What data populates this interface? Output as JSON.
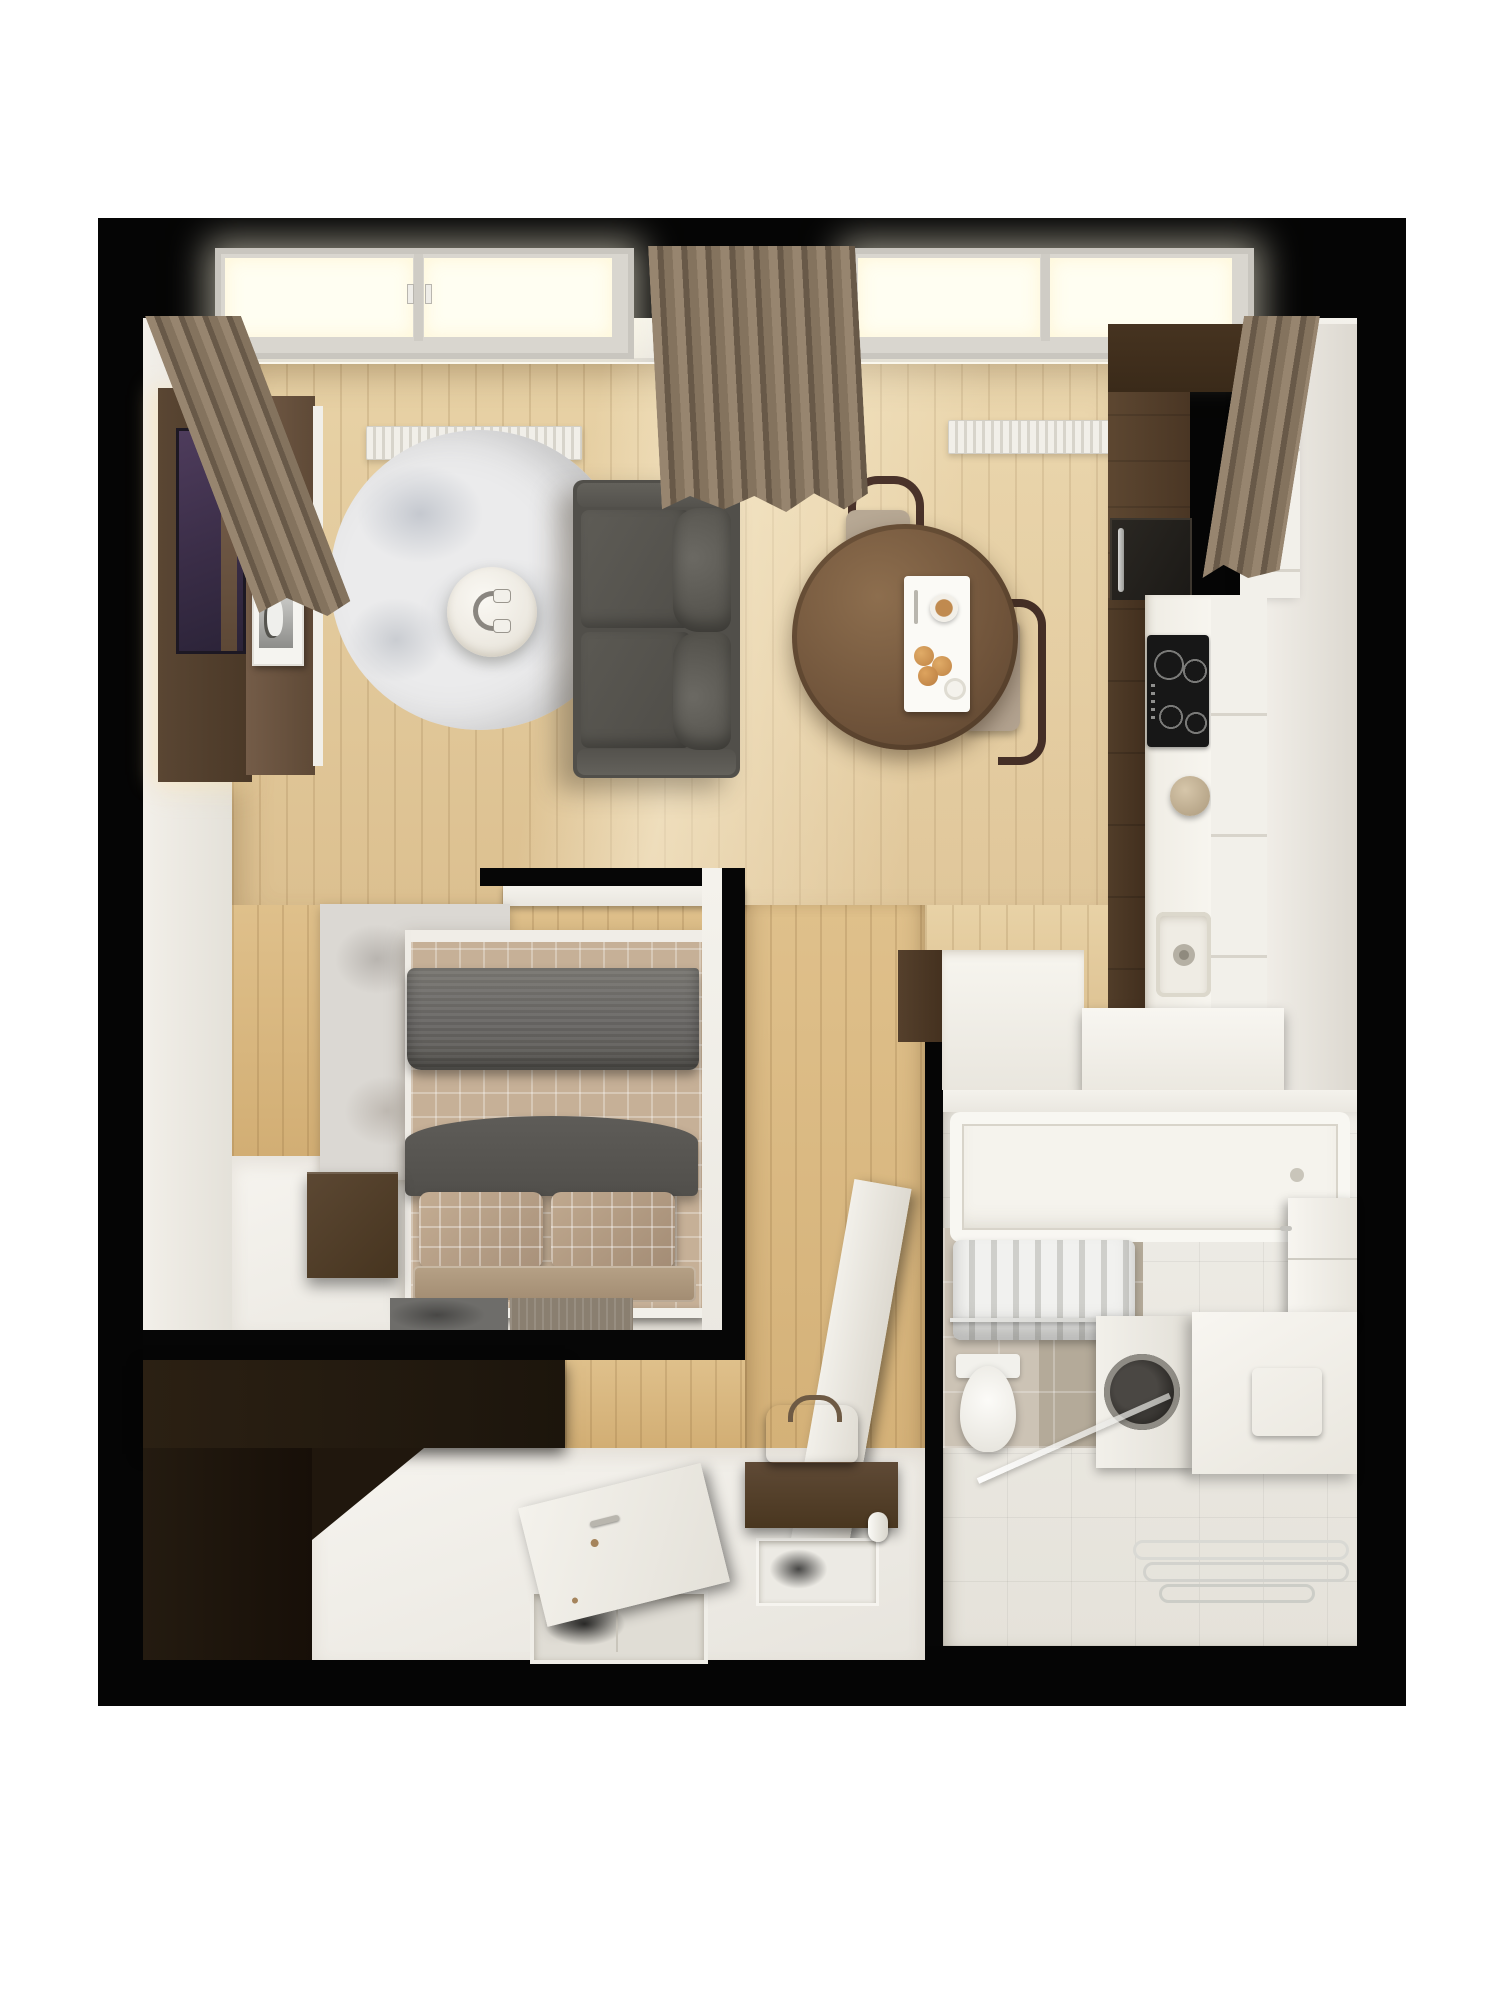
{
  "scene": {
    "type": "3d-floor-plan-render",
    "view": "top-down",
    "description": "Top-down 3D render of a small one-bedroom apartment on a black background"
  },
  "palette": {
    "page_bg": "#ffffff",
    "frame": "#050505",
    "wall": "#efece5",
    "wood_light": "#e3cb9d",
    "wood_dark": "#d5b47e",
    "curtain_brown": "#85735f",
    "sofa_gray": "#55534e",
    "kitchen_wood": "#54402d",
    "counter_white": "#f4f1ea",
    "rug_gray": "#e7e7e8",
    "bed_sheet": "#c6b097",
    "blanket_gray": "#6e6c67",
    "tile_beige": "#c6bcae",
    "wardrobe_dark": "#241b11",
    "glow_warm": "#fff8e6"
  },
  "rooms": [
    {
      "id": "living-room",
      "label": "Living room",
      "furniture": [
        "sofa",
        "round-rug",
        "side-table",
        "headphones",
        "tv-wall-panel",
        "wall-artwork",
        "photo-frame",
        "radiator",
        "skylight-windows",
        "curtains"
      ]
    },
    {
      "id": "dining-area",
      "label": "Dining area",
      "furniture": [
        "round-dining-table",
        "dining-chair",
        "dining-chair",
        "breakfast-tray"
      ]
    },
    {
      "id": "kitchen",
      "label": "Kitchen",
      "furniture": [
        "tall-cabinets",
        "built-in-oven",
        "induction-cooktop",
        "countertop",
        "sink",
        "kettle",
        "white-cabinet-column",
        "kitchen-peninsula"
      ]
    },
    {
      "id": "bedroom",
      "label": "Bedroom",
      "furniture": [
        "double-bed",
        "plaid-pillows",
        "knit-blanket",
        "area-rug",
        "nightstand",
        "bedside-mats"
      ]
    },
    {
      "id": "hallway",
      "label": "Hallway / Entry",
      "furniture": [
        "wardrobe",
        "open-entry-door",
        "floor-mat",
        "console-shelf",
        "leather-bag",
        "interior-door",
        "paper-roll"
      ]
    },
    {
      "id": "bathroom",
      "label": "Bathroom",
      "furniture": [
        "bathtub",
        "towel-rail",
        "towels",
        "toilet",
        "washing-machine",
        "laundry-counter",
        "vanity-unit",
        "shower-screen",
        "towel-hooks"
      ]
    }
  ]
}
